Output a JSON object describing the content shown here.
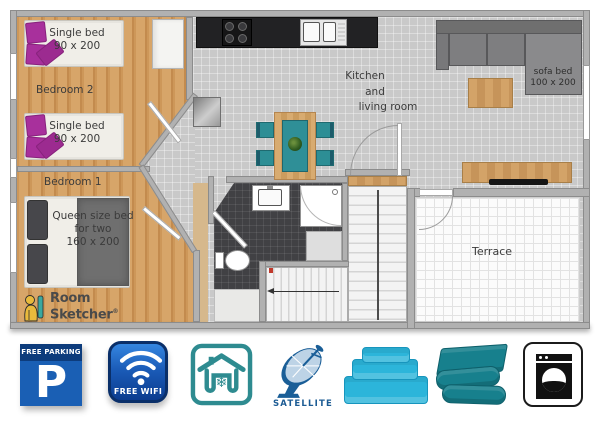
{
  "plan": {
    "bedroom2": {
      "label": "Bedroom 2",
      "beds": [
        {
          "line1": "Single bed",
          "line2": "90 x 200"
        },
        {
          "line1": "Single bed",
          "line2": "90 x 200"
        }
      ]
    },
    "bedroom1": {
      "label": "Bedroom 1",
      "bed": {
        "line1": "Queen size bed",
        "line2": "for two",
        "line3": "160 x 200"
      }
    },
    "kitchen_living": {
      "line1": "Kitchen",
      "line2": "and",
      "line3": "living room",
      "sofa": {
        "line1": "sofa bed",
        "line2": "100 x 200"
      }
    },
    "terrace": {
      "label": "Terrace"
    },
    "logo": {
      "word1": "Room",
      "word2": "Sketcher",
      "reg": "®"
    }
  },
  "amenities": {
    "parking": {
      "header": "FREE PARKING",
      "letter": "P"
    },
    "wifi": {
      "label": "FREE WIFI"
    },
    "air_conditioning": {
      "snowflake": "❄"
    },
    "satellite": {
      "label": "SATELLITE"
    }
  },
  "colors": {
    "wood_floor": "#cf9a5f",
    "tile_floor": "#c9c9c9",
    "bathroom_tile": "#414144",
    "terrace_floor": "#fbfbfb",
    "accent_teal": "#2e8f96",
    "pillow_magenta": "#a8309c",
    "parking_blue": "#1a5fb4",
    "wifi_blue": "#1b5cb8",
    "ac_teal": "#2e8b90",
    "satellite_blue": "#1a5e97",
    "towel_turquoise": "#2cb5da",
    "linen_teal": "#17808d"
  }
}
